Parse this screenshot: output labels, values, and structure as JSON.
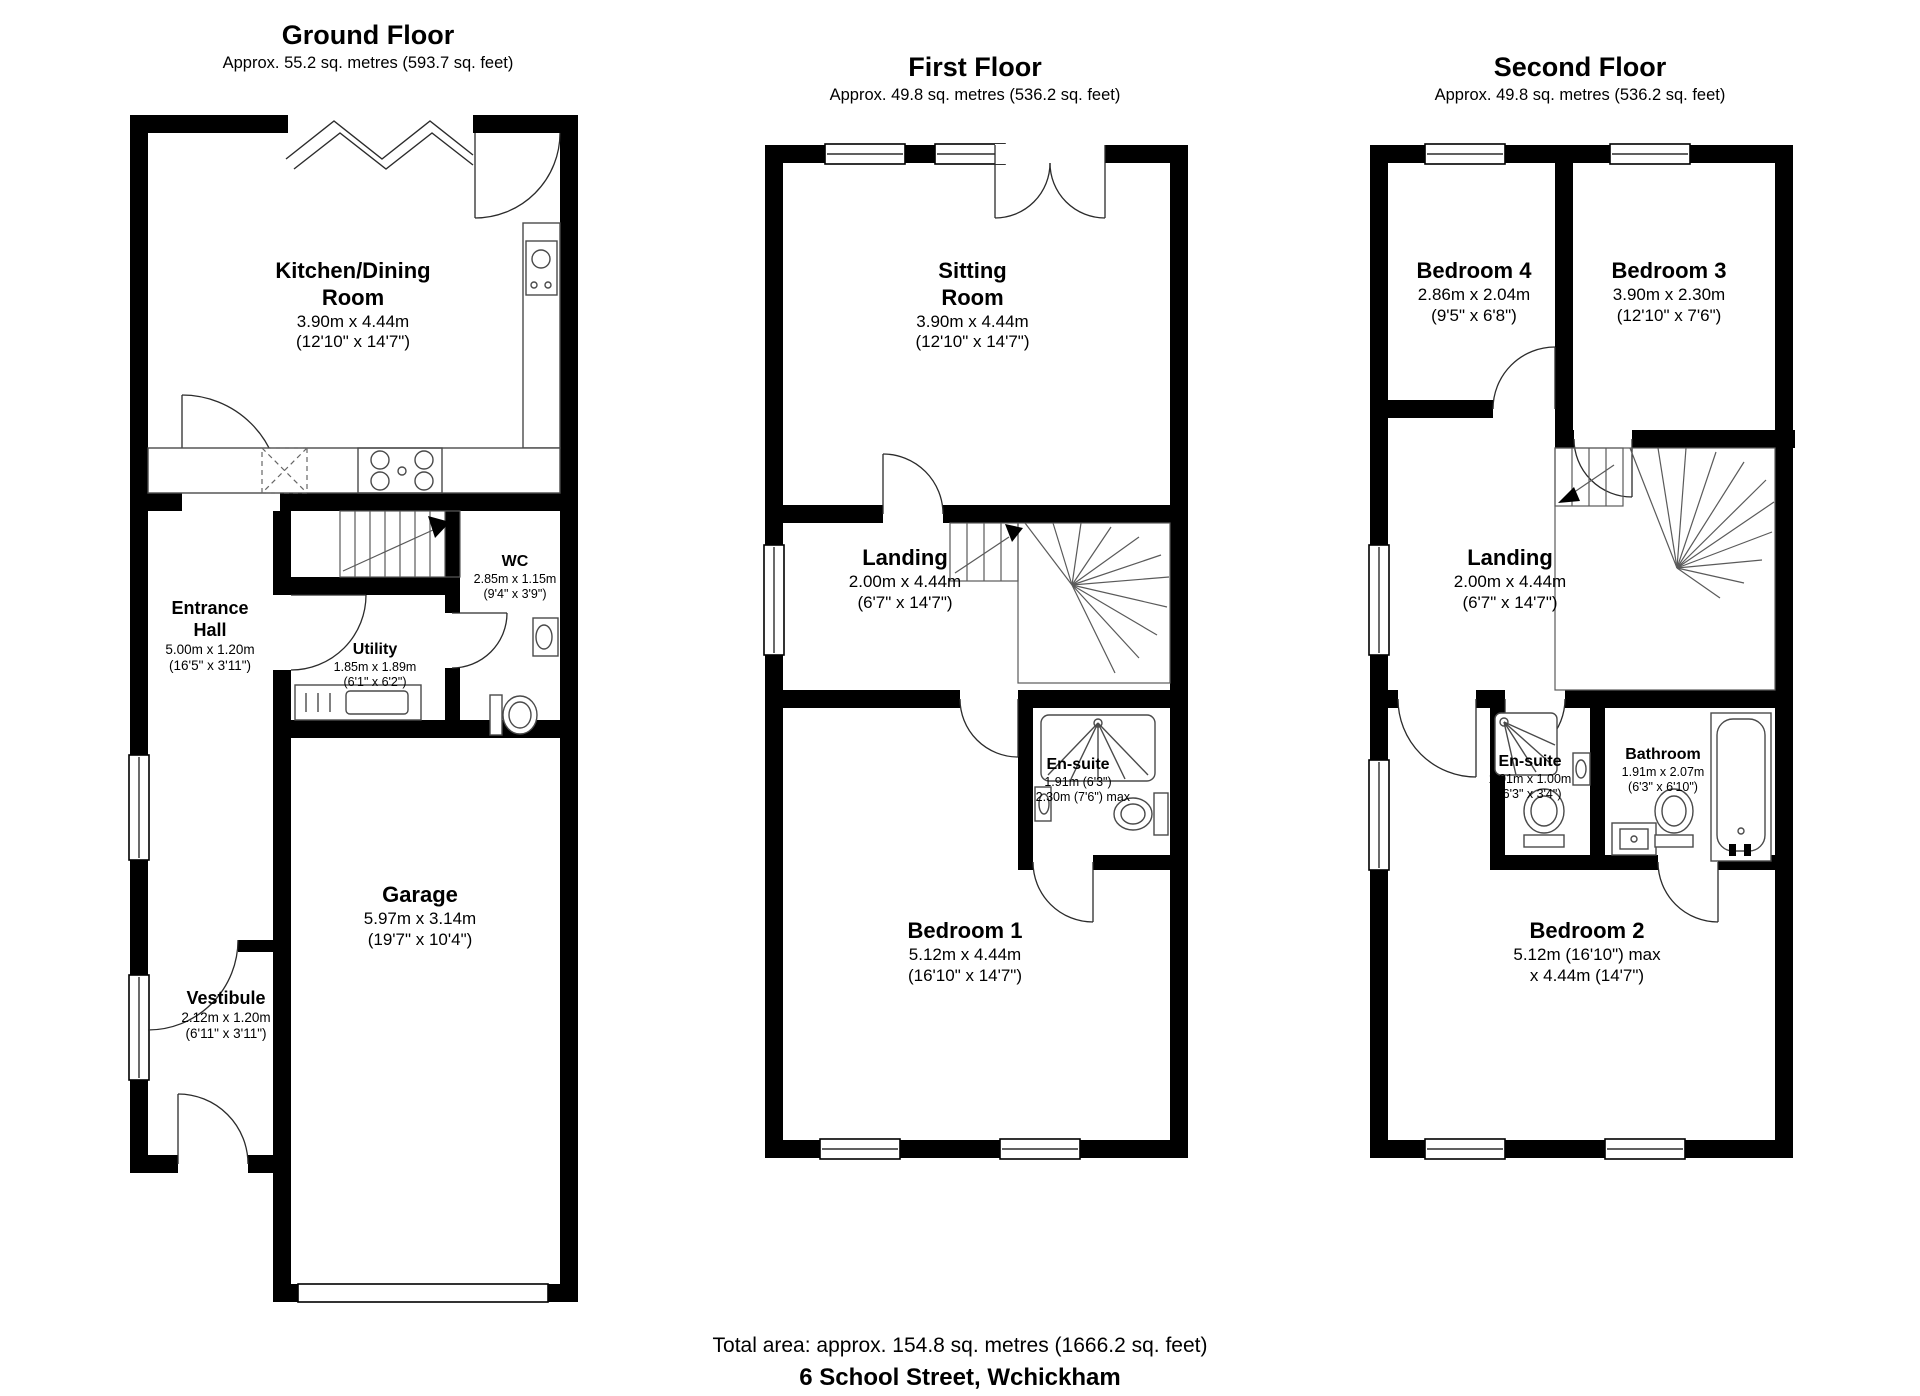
{
  "page": {
    "total_area": "Total area: approx. 154.8 sq. metres (1666.2 sq. feet)",
    "address": "6 School Street, Wchickham"
  },
  "colors": {
    "wall": "#000000",
    "line": "#4a4a4a",
    "background": "#ffffff"
  },
  "floors": {
    "ground": {
      "title": "Ground Floor",
      "area": "Approx. 55.2 sq. metres (593.7 sq. feet)",
      "rooms": {
        "kitchen": {
          "name": "Kitchen/Dining Room",
          "d1": "3.90m x 4.44m",
          "d2": "(12'10\" x 14'7\")"
        },
        "wc": {
          "name": "WC",
          "d1": "2.85m x 1.15m",
          "d2": "(9'4\" x 3'9\")"
        },
        "entrance_hall": {
          "name": "Entrance Hall",
          "d1": "5.00m x 1.20m",
          "d2": "(16'5\" x 3'11\")"
        },
        "utility": {
          "name": "Utility",
          "d1": "1.85m x 1.89m",
          "d2": "(6'1\" x 6'2\")"
        },
        "garage": {
          "name": "Garage",
          "d1": "5.97m x 3.14m",
          "d2": "(19'7\" x 10'4\")"
        },
        "vestibule": {
          "name": "Vestibule",
          "d1": "2.12m x 1.20m",
          "d2": "(6'11\" x 3'11\")"
        }
      }
    },
    "first": {
      "title": "First Floor",
      "area": "Approx. 49.8 sq. metres (536.2 sq. feet)",
      "rooms": {
        "sitting": {
          "name": "Sitting Room",
          "d1": "3.90m x 4.44m",
          "d2": "(12'10\" x 14'7\")"
        },
        "landing": {
          "name": "Landing",
          "d1": "2.00m x 4.44m",
          "d2": "(6'7\" x 14'7\")"
        },
        "ensuite": {
          "name": "En-suite",
          "d1": "1.91m (6'3\")",
          "d2": "x 2.30m (7'6\") max"
        },
        "bedroom1": {
          "name": "Bedroom 1",
          "d1": "5.12m x 4.44m",
          "d2": "(16'10\" x 14'7\")"
        }
      }
    },
    "second": {
      "title": "Second Floor",
      "area": "Approx. 49.8 sq. metres (536.2 sq. feet)",
      "rooms": {
        "bedroom4": {
          "name": "Bedroom 4",
          "d1": "2.86m x 2.04m",
          "d2": "(9'5\" x 6'8\")"
        },
        "bedroom3": {
          "name": "Bedroom 3",
          "d1": "3.90m x 2.30m",
          "d2": "(12'10\" x 7'6\")"
        },
        "landing": {
          "name": "Landing",
          "d1": "2.00m x 4.44m",
          "d2": "(6'7\" x 14'7\")"
        },
        "ensuite": {
          "name": "En-suite",
          "d1": "1.91m x 1.00m",
          "d2": "(6'3\" x 3'4\")"
        },
        "bathroom": {
          "name": "Bathroom",
          "d1": "1.91m x 2.07m",
          "d2": "(6'3\" x 6'10\")"
        },
        "bedroom2": {
          "name": "Bedroom 2",
          "d1": "5.12m (16'10\") max",
          "d2": "x 4.44m (14'7\")"
        }
      }
    }
  }
}
